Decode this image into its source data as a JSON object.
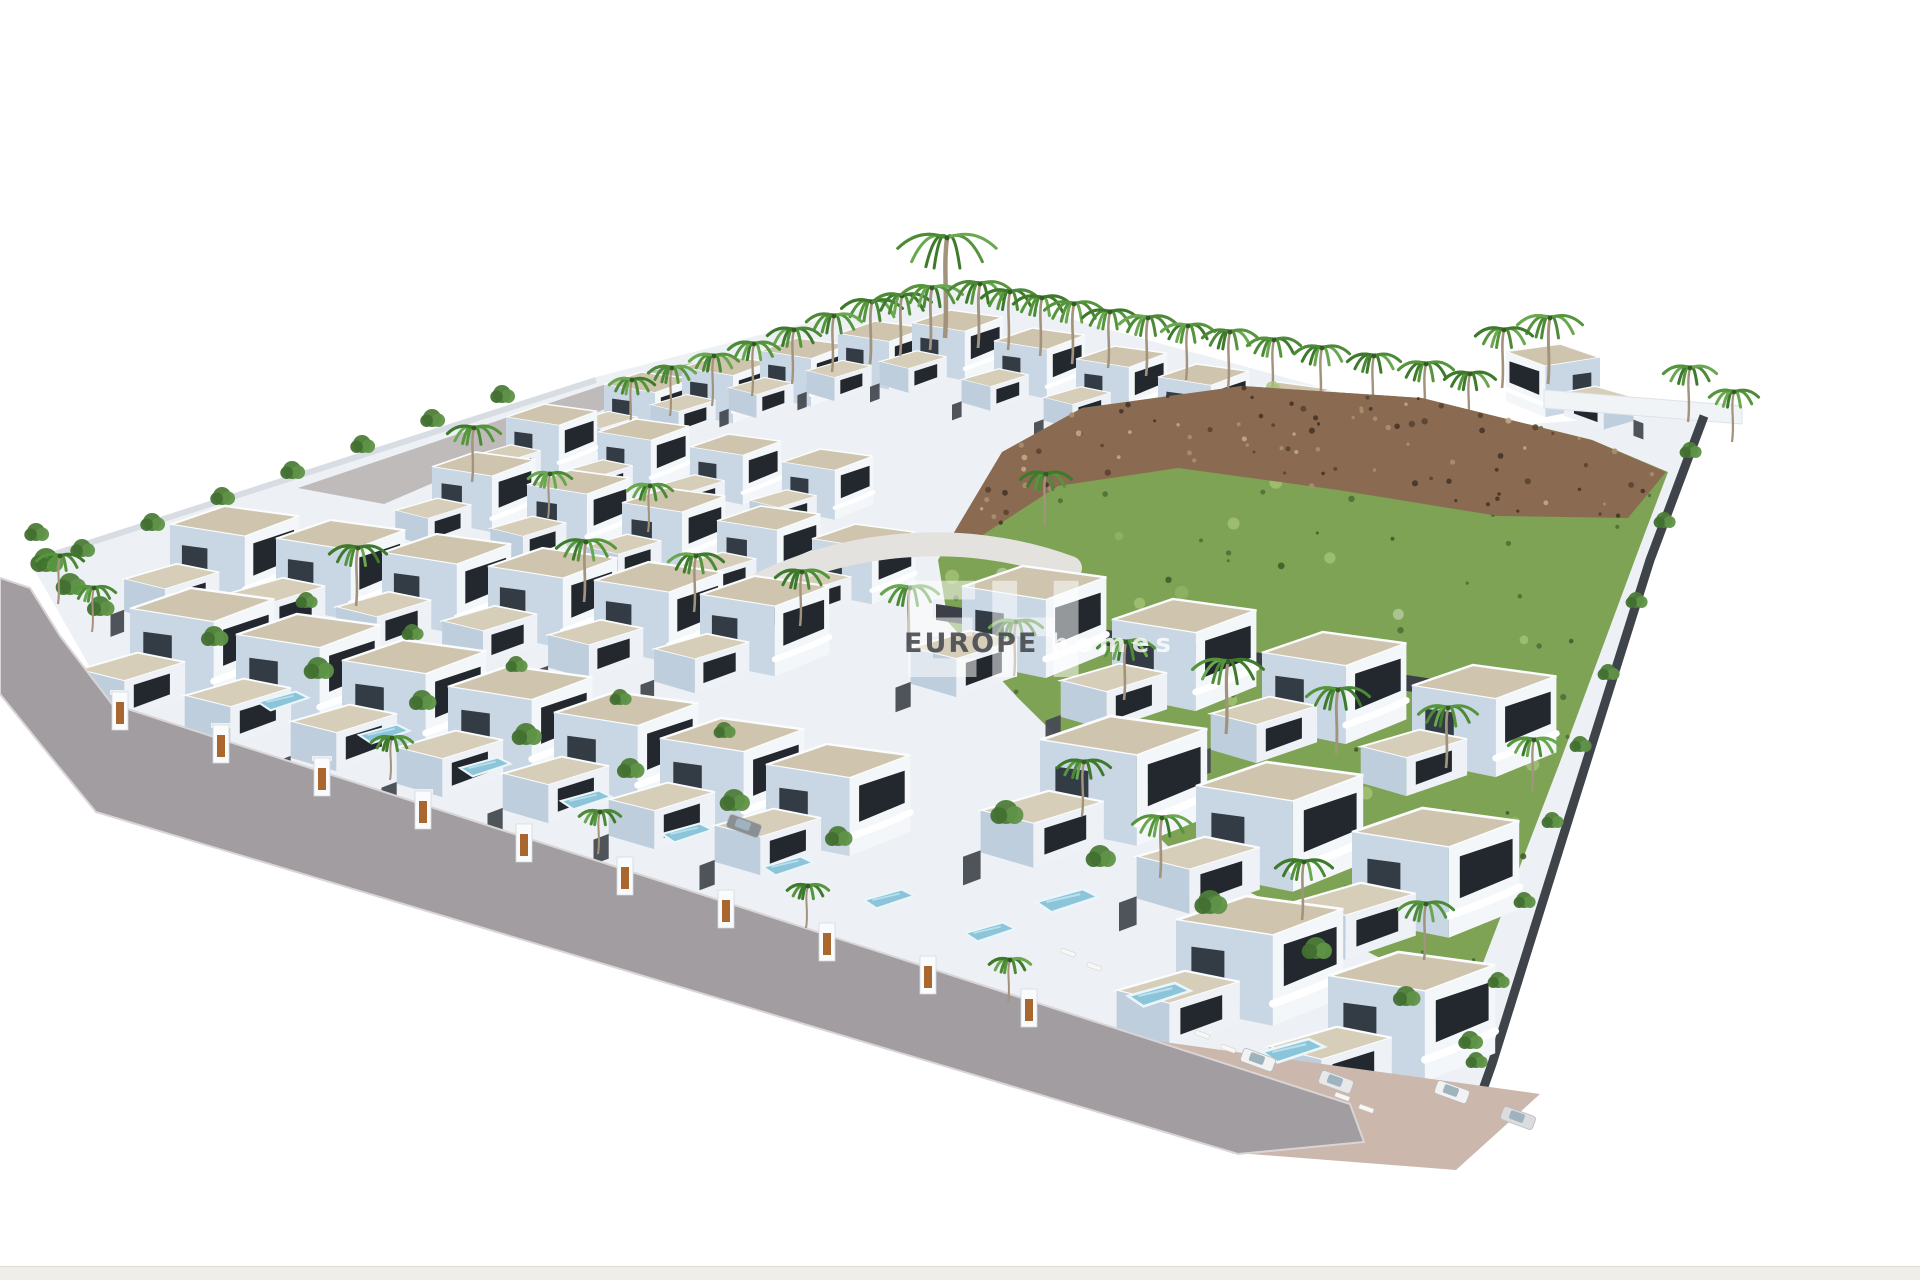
{
  "watermark": {
    "logo": "EH",
    "brand_primary": "EUROPE",
    "brand_secondary": "homes"
  },
  "palette": {
    "bg": "#ffffff",
    "plot": "#edf0f4",
    "roof": "#cfc5ae",
    "roof2": "#d7ceb9",
    "faceR": "#f4f7fa",
    "faceL": "#c9d6e4",
    "face2": "#eef2f7",
    "faceL2": "#bfcedd",
    "glass": "#23282e",
    "glassL": "#333b44",
    "wall": "#474b52",
    "wallDark": "#3c4046",
    "road": "#a29da0",
    "backRoad": "#b7b2b0",
    "sidewalk": "#cbb7ac",
    "driveway": "#e3e2de",
    "hill": "#7fa355",
    "hillLight": "#a4c277",
    "hillDark": "#4e7136",
    "rock": "#8a6b51",
    "rockDark": "#5a4433",
    "rockLight": "#a98f70",
    "pool": "#8cc5d9",
    "poolEdge": "#eaf6fa",
    "door": "#a9662e",
    "trunk": "#a4937c",
    "greens": [
      "#3e7a2c",
      "#55953c",
      "#6aa84f",
      "#4c8a38"
    ],
    "bushGreens": [
      "#4e7d39",
      "#5f9247",
      "#427032"
    ],
    "terrace": "#f1f4f6",
    "fenceLine": "#3f434a",
    "curb": "#d9d5d6"
  },
  "scene": {
    "width": 1920,
    "height": 1280,
    "seed": 7,
    "plot": [
      [
        30,
        562
      ],
      [
        600,
        376
      ],
      [
        950,
        286
      ],
      [
        1470,
        428
      ],
      [
        1706,
        412
      ],
      [
        1648,
        560
      ],
      [
        1572,
        808
      ],
      [
        1460,
        1164
      ],
      [
        1252,
        1150
      ],
      [
        880,
        1004
      ],
      [
        112,
        706
      ]
    ],
    "back_road": [
      [
        298,
        488
      ],
      [
        636,
        374
      ],
      [
        728,
        356
      ],
      [
        384,
        504
      ]
    ],
    "terrace": [
      [
        1544,
        390
      ],
      [
        1742,
        406
      ],
      [
        1742,
        424
      ],
      [
        1544,
        408
      ]
    ],
    "hill_green": [
      [
        938,
        560
      ],
      [
        1004,
        452
      ],
      [
        1082,
        408
      ],
      [
        1242,
        386
      ],
      [
        1422,
        398
      ],
      [
        1592,
        440
      ],
      [
        1668,
        472
      ],
      [
        1640,
        546
      ],
      [
        1560,
        762
      ],
      [
        1468,
        1002
      ],
      [
        1356,
        946
      ],
      [
        1178,
        856
      ],
      [
        1018,
        698
      ],
      [
        948,
        622
      ]
    ],
    "rock_ridge": [
      [
        940,
        556
      ],
      [
        1002,
        452
      ],
      [
        1082,
        408
      ],
      [
        1242,
        386
      ],
      [
        1422,
        398
      ],
      [
        1592,
        440
      ],
      [
        1666,
        472
      ],
      [
        1628,
        518
      ],
      [
        1498,
        516
      ],
      [
        1338,
        490
      ],
      [
        1178,
        468
      ],
      [
        1058,
        486
      ],
      [
        978,
        538
      ]
    ],
    "retaining": [
      [
        936,
        604
      ],
      [
        1506,
        690
      ],
      [
        1506,
        706
      ],
      [
        936,
        620
      ]
    ],
    "right_fence": [
      [
        1704,
        416
      ],
      [
        1650,
        560
      ],
      [
        1572,
        808
      ],
      [
        1492,
        1064
      ],
      [
        1458,
        1160
      ]
    ],
    "driveway": "M742,594 C838,540 962,528 1070,568",
    "wall_band": [
      [
        108,
        706
      ],
      [
        1350,
        1104
      ],
      [
        1350,
        1126
      ],
      [
        108,
        730
      ]
    ],
    "sidewalk": [
      [
        874,
        1002
      ],
      [
        1540,
        1094
      ],
      [
        1456,
        1170
      ],
      [
        1250,
        1154
      ]
    ],
    "road": [
      [
        0,
        578
      ],
      [
        30,
        588
      ],
      [
        60,
        636
      ],
      [
        112,
        704
      ],
      [
        1350,
        1104
      ],
      [
        1364,
        1142
      ],
      [
        1238,
        1154
      ],
      [
        96,
        812
      ],
      [
        50,
        756
      ],
      [
        0,
        694
      ]
    ],
    "boundary_line": [
      [
        36,
        560
      ],
      [
        596,
        380
      ]
    ],
    "villa_rows": [
      {
        "name": "ridge-left",
        "x": 604,
        "y": 372,
        "dx": 78,
        "dy": -17,
        "count": 4,
        "scale": 0.58
      },
      {
        "name": "ridge-right",
        "x": 912,
        "y": 310,
        "dx": 82,
        "dy": 18,
        "count": 8,
        "scale": 0.6
      },
      {
        "name": "upper-a",
        "x": 506,
        "y": 404,
        "dx": 92,
        "dy": 15,
        "count": 4,
        "scale": 0.6
      },
      {
        "name": "upper-b",
        "x": 432,
        "y": 452,
        "dx": 95,
        "dy": 18,
        "count": 5,
        "scale": 0.68
      },
      {
        "name": "mid-a",
        "x": 170,
        "y": 506,
        "dx": 106,
        "dy": 14,
        "count": 6,
        "scale": 0.85
      },
      {
        "name": "mid-b",
        "x": 130,
        "y": 588,
        "dx": 106,
        "dy": 26,
        "count": 7,
        "scale": 0.95
      },
      {
        "name": "right-a",
        "x": 962,
        "y": 566,
        "dx": 150,
        "dy": 33,
        "count": 4,
        "scale": 0.95
      },
      {
        "name": "right-b",
        "x": 1040,
        "y": 716,
        "dx": 156,
        "dy": 46,
        "count": 3,
        "scale": 1.1
      },
      {
        "name": "right-c",
        "x": 1176,
        "y": 896,
        "dx": 152,
        "dy": 56,
        "count": 2,
        "scale": 1.1
      }
    ],
    "corner_villa": {
      "x": 1600,
      "y": 344,
      "scale": 0.62,
      "flip": true
    },
    "gates": {
      "x0": 120,
      "y0": 714,
      "dx": 101,
      "dy": 33,
      "count": 10
    },
    "pools_front": {
      "x0": 258,
      "y0": 702,
      "dx": 101,
      "dy": 33,
      "count": 8
    },
    "pools_extra": [
      [
        1036,
        902
      ],
      [
        1128,
        996
      ],
      [
        1262,
        1052
      ]
    ],
    "palms_ridge": [
      [
        945,
        238,
        100
      ],
      [
        870,
        302,
        62
      ],
      [
        900,
        296,
        60
      ],
      [
        930,
        288,
        62
      ],
      [
        978,
        284,
        64
      ],
      [
        1008,
        292,
        58
      ],
      [
        1040,
        298,
        58
      ],
      [
        1072,
        304,
        60
      ],
      [
        1108,
        312,
        56
      ],
      [
        1146,
        318,
        58
      ],
      [
        1186,
        326,
        54
      ],
      [
        1228,
        332,
        56
      ],
      [
        1272,
        340,
        54
      ],
      [
        1320,
        348,
        56
      ],
      [
        1372,
        356,
        54
      ],
      [
        1424,
        364,
        56
      ],
      [
        1468,
        374,
        52
      ],
      [
        832,
        316,
        56
      ],
      [
        792,
        330,
        54
      ],
      [
        752,
        344,
        52
      ],
      [
        712,
        356,
        50
      ],
      [
        670,
        368,
        48
      ],
      [
        630,
        380,
        46
      ],
      [
        1548,
        318,
        66
      ],
      [
        1502,
        330,
        58
      ],
      [
        1688,
        368,
        54
      ],
      [
        1732,
        392,
        50
      ]
    ],
    "palms_fore": [
      [
        472,
        428,
        54
      ],
      [
        356,
        548,
        58
      ],
      [
        584,
        542,
        60
      ],
      [
        694,
        556,
        56
      ],
      [
        800,
        572,
        54
      ],
      [
        908,
        588,
        58
      ],
      [
        1044,
        474,
        52
      ],
      [
        648,
        486,
        46
      ],
      [
        548,
        474,
        44
      ],
      [
        1226,
        662,
        72
      ],
      [
        1336,
        690,
        64
      ],
      [
        1446,
        708,
        60
      ],
      [
        1124,
        642,
        58
      ],
      [
        1014,
        622,
        54
      ],
      [
        1160,
        818,
        60
      ],
      [
        1302,
        862,
        58
      ],
      [
        1424,
        904,
        56
      ],
      [
        1082,
        762,
        54
      ],
      [
        1532,
        740,
        52
      ],
      [
        58,
        556,
        48
      ],
      [
        92,
        588,
        44
      ],
      [
        390,
        738,
        42
      ],
      [
        598,
        812,
        42
      ],
      [
        806,
        886,
        42
      ],
      [
        1008,
        960,
        42
      ]
    ],
    "bushes": [
      [
        82,
        548,
        9
      ],
      [
        152,
        522,
        9
      ],
      [
        222,
        496,
        9
      ],
      [
        292,
        470,
        9
      ],
      [
        362,
        444,
        9
      ],
      [
        432,
        418,
        9
      ],
      [
        502,
        394,
        9
      ],
      [
        46,
        560,
        12
      ],
      [
        70,
        584,
        11
      ],
      [
        100,
        606,
        10
      ],
      [
        36,
        532,
        9
      ],
      [
        214,
        636,
        10
      ],
      [
        318,
        668,
        11
      ],
      [
        422,
        700,
        10
      ],
      [
        526,
        734,
        11
      ],
      [
        630,
        768,
        10
      ],
      [
        734,
        800,
        11
      ],
      [
        838,
        836,
        10
      ],
      [
        306,
        600,
        8
      ],
      [
        412,
        632,
        8
      ],
      [
        516,
        664,
        8
      ],
      [
        620,
        697,
        8
      ],
      [
        724,
        730,
        8
      ],
      [
        1006,
        812,
        12
      ],
      [
        1100,
        856,
        11
      ],
      [
        1210,
        902,
        12
      ],
      [
        1316,
        948,
        11
      ],
      [
        1406,
        996,
        10
      ],
      [
        1470,
        1040,
        9
      ],
      [
        1690,
        450,
        8
      ],
      [
        1664,
        520,
        8
      ],
      [
        1636,
        600,
        8
      ],
      [
        1608,
        672,
        8
      ],
      [
        1580,
        744,
        8
      ],
      [
        1552,
        820,
        8
      ],
      [
        1524,
        900,
        8
      ],
      [
        1498,
        980,
        8
      ],
      [
        1476,
        1060,
        8
      ]
    ],
    "loungers": [
      [
        1062,
        948
      ],
      [
        1088,
        962
      ],
      [
        1196,
        1030
      ],
      [
        1222,
        1044
      ],
      [
        1336,
        1092
      ],
      [
        1360,
        1104
      ]
    ],
    "cars": [
      {
        "x": 1258,
        "y": 1060,
        "rot": 20,
        "color": "#f2f2f2"
      },
      {
        "x": 1336,
        "y": 1082,
        "rot": 20,
        "color": "#e8e8ea"
      },
      {
        "x": 1452,
        "y": 1092,
        "rot": 20,
        "color": "#f2f2f2"
      },
      {
        "x": 1518,
        "y": 1118,
        "rot": 20,
        "color": "#dcdcde"
      },
      {
        "x": 744,
        "y": 826,
        "rot": 20,
        "color": "#8a8f94"
      }
    ],
    "speckles": {
      "hill_dark": 70,
      "hill_light": 30,
      "rock_dark": 60,
      "rock_light": 40
    }
  }
}
